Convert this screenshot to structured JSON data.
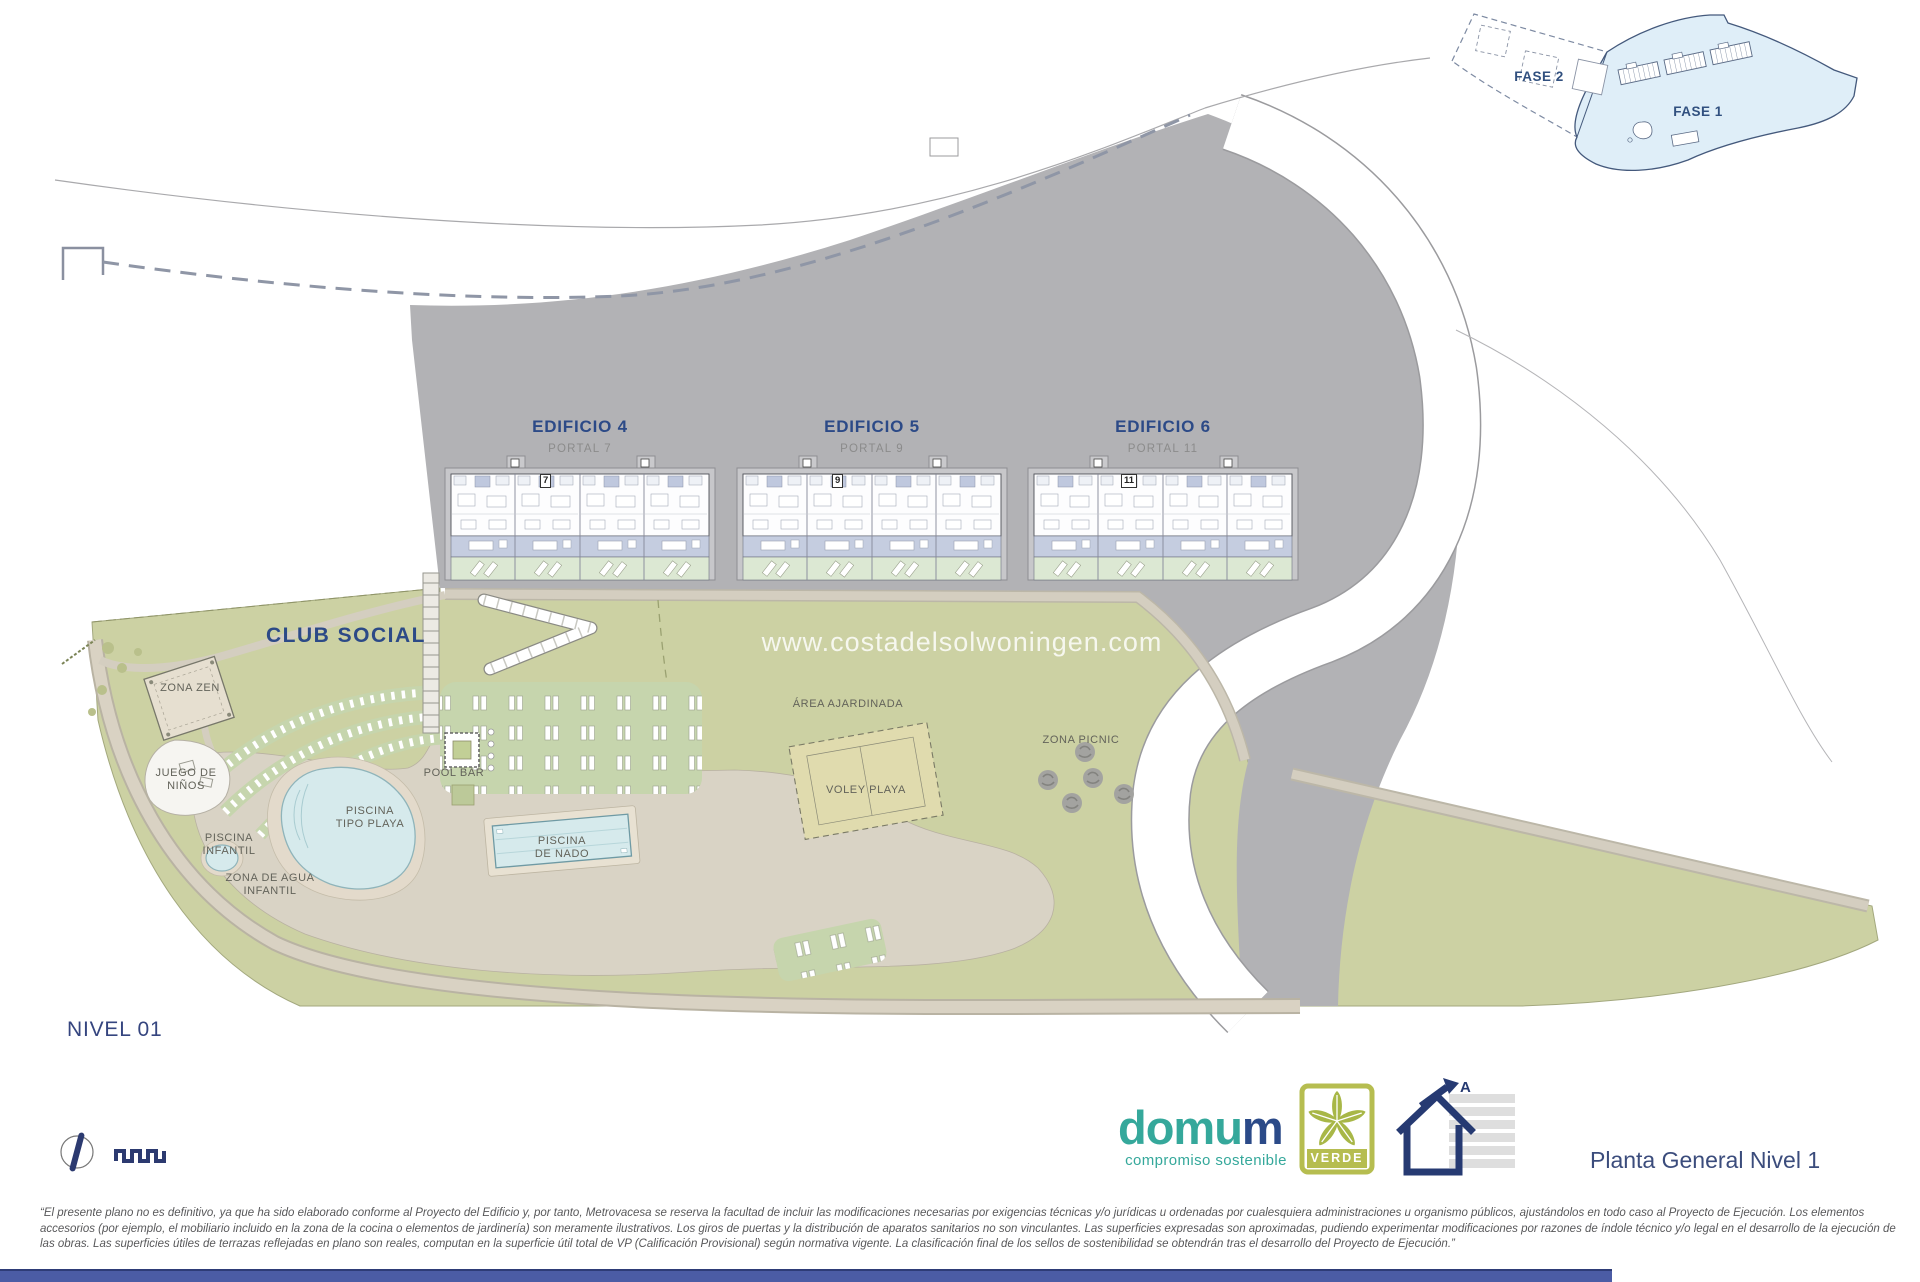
{
  "inset": {
    "fase1_label": "FASE 1",
    "fase2_label": "FASE 2"
  },
  "buildings": [
    {
      "name": "EDIFICIO 4",
      "portal": "PORTAL 7",
      "number": "7"
    },
    {
      "name": "EDIFICIO 5",
      "portal": "PORTAL 9",
      "number": "9"
    },
    {
      "name": "EDIFICIO 6",
      "portal": "PORTAL 11",
      "number": "11"
    }
  ],
  "areas": {
    "club_social": "CLUB SOCIAL",
    "zona_zen": "ZONA ZEN",
    "juego_ninos": "JUEGO DE\nNIÑOS",
    "piscina_infantil": "PISCINA\nINFANTIL",
    "zona_agua_infantil": "ZONA DE AGUA\nINFANTIL",
    "piscina_tipo_playa": "PISCINA\nTIPO PLAYA",
    "pool_bar": "POOL BAR",
    "piscina_nado": "PISCINA\nDE NADO",
    "area_ajardinada": "ÁREA AJARDINADA",
    "voley_playa": "VOLEY PLAYA",
    "zona_picnic": "ZONA PICNIC"
  },
  "watermark": "www.costadelsolwoningen.com",
  "level_label": "NIVEL 01",
  "plan_title": "Planta General Nivel 1",
  "logo": {
    "brand_main": "domu",
    "brand_accent": "m",
    "tagline": "compromiso sostenible",
    "badge_label": "VERDE",
    "energy_rating": "A"
  },
  "colors": {
    "hillside_gray": "#b2b2b5",
    "estate_olive": "#ccd1a3",
    "pool_blue": "#d6eaec",
    "path_beige": "#d9d2c3",
    "terrace_lavender": "#c5cde0",
    "garden_green": "#dce8d3",
    "navy_text": "#2c4a87",
    "brand_teal": "#35a89b",
    "verde_olive": "#b6bd50",
    "footer_blue": "#4b5ca5"
  },
  "disclaimer_lines": [
    "“El presente plano no es definitivo, ya que ha sido elaborado conforme al Proyecto del Edificio y, por tanto, Metrovacesa se reserva la facultad de incluir las modificaciones necesarias por exigencias técnicas y/o jurídicas u ordenadas por cualesquiera administraciones u organismo públicos, ajustándolos en todo caso al Proyecto de Ejecución. Los elementos",
    "accesorios (por ejemplo, el mobiliario incluido en la zona de la cocina o elementos de jardinería) son meramente ilustrativos. Los giros de puertas y la distribución de aparatos sanitarios no son vinculantes. Las superficies expresadas son aproximadas, pudiendo experimentar modificaciones por razones de índole técnico y/o legal en el desarrollo de la ejecución de",
    "las obras. Las superficies útiles de terrazas reflejadas en plano son reales, computan en la superficie útil total de VP (Calificación Provisional) según normativa vigente. La clasificación final de los sellos de sostenibilidad se obtendrán tras el desarrollo del Proyecto de Ejecución.”"
  ]
}
